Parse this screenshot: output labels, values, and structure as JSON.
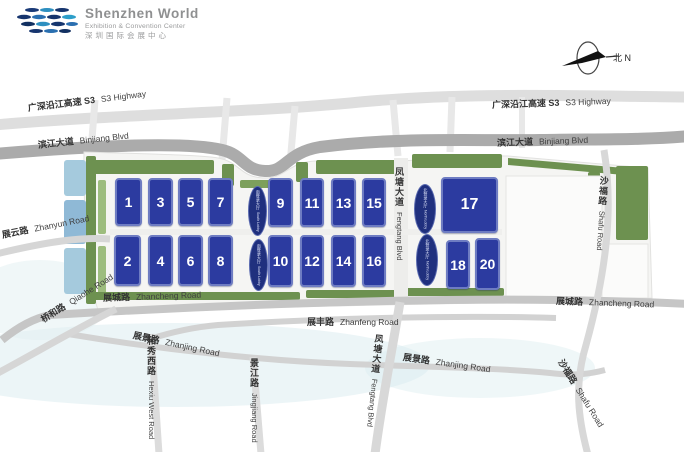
{
  "logo": {
    "title": "Shenzhen World",
    "subtitle": "Exhibition & Convention Center",
    "chinese": "深圳国际会展中心"
  },
  "compass": {
    "label": "北 N"
  },
  "roads": {
    "s3_left": {
      "cn": "广深沿江高速 S3",
      "en": "S3 Highway"
    },
    "s3_right": {
      "cn": "广深沿江高速 S3",
      "en": "S3 Highway"
    },
    "binjiang_left": {
      "cn": "滨江大道",
      "en": "Binjiang Blvd"
    },
    "binjiang_right": {
      "cn": "滨江大道",
      "en": "Binjiang Blvd"
    },
    "zhanyun": {
      "cn": "展云路",
      "en": "Zhanyun Road"
    },
    "zhancheng_left": {
      "cn": "展城路",
      "en": "Zhancheng Road"
    },
    "zhancheng_right": {
      "cn": "展城路",
      "en": "Zhancheng Road"
    },
    "zhanfeng": {
      "cn": "展丰路",
      "en": "Zhanfeng Road"
    },
    "zhanjing_left": {
      "cn": "展景路",
      "en": "Zhanjing Road"
    },
    "zhanjing_right": {
      "cn": "展景路",
      "en": "Zhanjing Road"
    },
    "qiaohe": {
      "cn": "桥和路",
      "en": "Qiaohe Road"
    },
    "hexiu": {
      "cn": "和秀西路",
      "en": "Hexiu West Road"
    },
    "jingjiang": {
      "cn": "景江路",
      "en": "Jingjiang Road"
    },
    "fengtang_mid": {
      "cn": "凤塘大道",
      "en": "Fengtang Blvd"
    },
    "fengtang_bottom": {
      "cn": "凤塘大道",
      "en": "Fengtang Blvd"
    },
    "shafu_top": {
      "cn": "沙福路",
      "en": "Shafu Road"
    },
    "shafu_bottom": {
      "cn": "沙福路",
      "en": "Shafu Road"
    }
  },
  "halls": {
    "h1": "1",
    "h2": "2",
    "h3": "3",
    "h4": "4",
    "h5": "5",
    "h6": "6",
    "h7": "7",
    "h8": "8",
    "h9": "9",
    "h10": "10",
    "h11": "11",
    "h12": "12",
    "h13": "13",
    "h14": "14",
    "h15": "15",
    "h16": "16",
    "h17": "17",
    "h18": "18",
    "h20": "20"
  },
  "lobbies": {
    "south_cn": "南登录大厅",
    "south_en": "South Lobby",
    "north_cn": "北登录大厅",
    "north_en": "North Lobby"
  },
  "colors": {
    "hall_blue": "#2c3ba0",
    "lobby_blue": "#20307e",
    "green": "#6d9150",
    "road_major": "#ababab",
    "road_minor": "#d6d6d6",
    "water": "#dcedf0"
  }
}
